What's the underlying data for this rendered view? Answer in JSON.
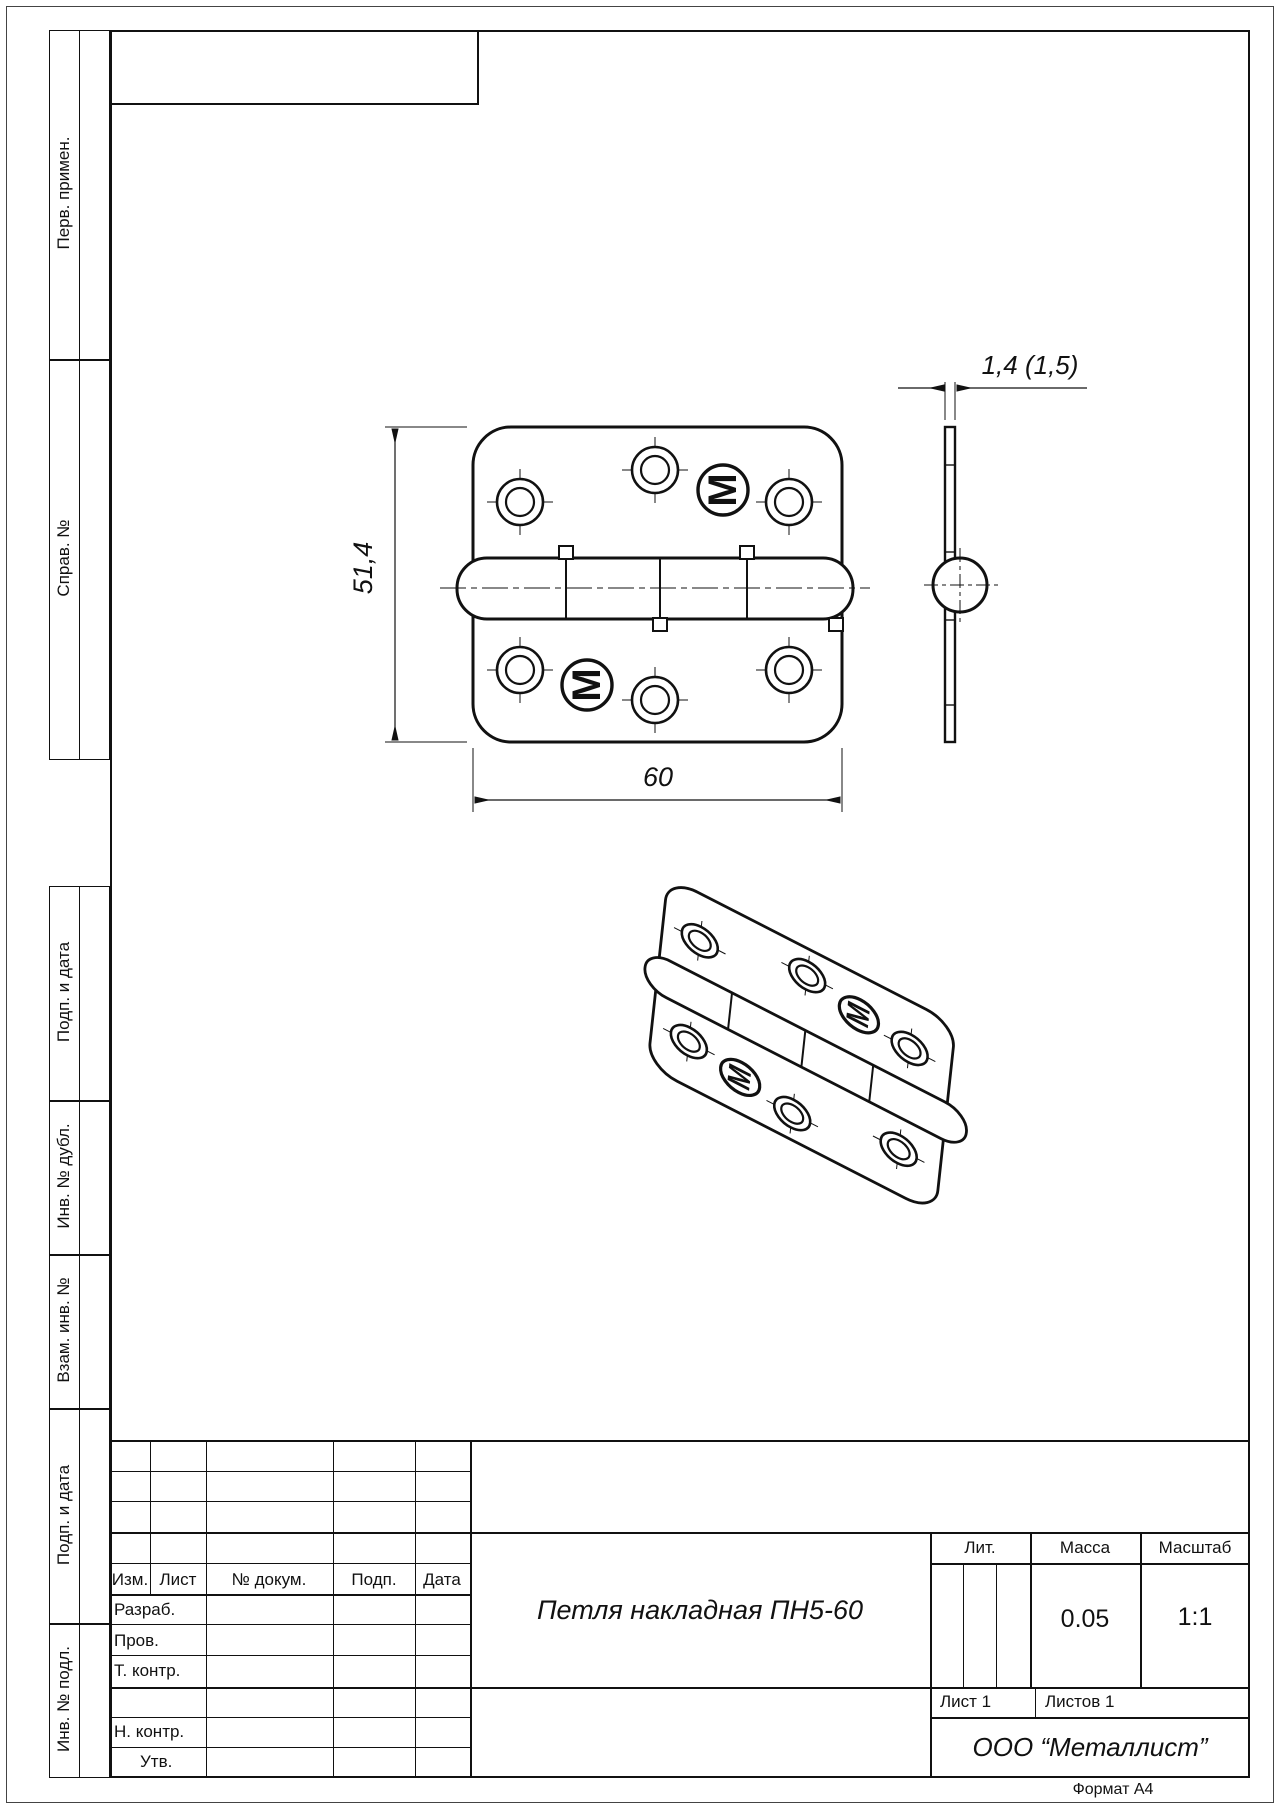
{
  "doc": {
    "title": "Петля накладная ПН5-60",
    "org": "ООО “Металлист”",
    "mass_value": "0.05",
    "scale_value": "1:1",
    "sheet": "Лист 1",
    "sheets": "Листов 1",
    "format": "Формат А4"
  },
  "stamp_headers": {
    "lit": "Лит.",
    "mass": "Масса",
    "scale": "Масштаб"
  },
  "revision_cols": {
    "izm": "Изм.",
    "list": "Лист",
    "doc_no": "№ докум.",
    "sign": "Подп.",
    "date": "Дата"
  },
  "signature_rows": {
    "dev": "Разраб.",
    "check": "Пров.",
    "tcontr": "Т. контр.",
    "ncontr": "Н. контр.",
    "approve": "Утв."
  },
  "sidebar": {
    "first_use": "Перв. примен.",
    "ref_no": "Справ. №",
    "sign_date_1": "Подп. и дата",
    "inv_dupl": "Инв. № дубл.",
    "repl_inv": "Взам. инв. №",
    "sign_date_2": "Подп. и дата",
    "inv_orig": "Инв. № подл."
  },
  "dims": {
    "height": "51,4",
    "width": "60",
    "thickness": "1,4  (1,5)"
  },
  "logo": {
    "letter": "M"
  }
}
